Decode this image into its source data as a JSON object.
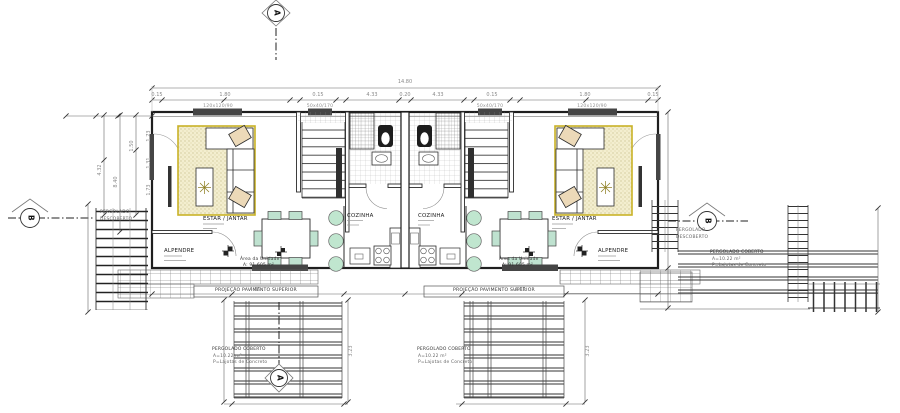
{
  "rooms": {
    "estar_jantar": "ESTAR / JANTAR",
    "cozinha": "COZINHA",
    "alpendre": "ALPENDRE",
    "area_line1": "Área da Unidade",
    "area_line2": "A: 91.605 m²"
  },
  "pergolas": {
    "coberto_title": "PERGOLADO COBERTO",
    "coberto_area": "A=10.22 m²",
    "coberto_floor": "P=Lajotas de Concreto",
    "descoberto_line1": "PERGOLADO",
    "descoberto_line2": "DESCOBERTO"
  },
  "projection": {
    "label": "PROJEÇÃO PAVIMENTO SUPERIOR"
  },
  "markers": {
    "section_a": "A",
    "section_b": "B"
  },
  "windows": {
    "large": "120x120/90",
    "small": "50x40/170"
  },
  "dims": {
    "total_width": "14.80",
    "top_segments": [
      "0.15",
      "1.80",
      "0.15",
      "4.33",
      "0.20",
      "4.33",
      "0.15",
      "1.80",
      "0.15"
    ],
    "left_vertical": [
      "1.50",
      "4.32",
      "8.40"
    ],
    "interior_vertical": [
      "1.73",
      "1.31",
      "1.73"
    ],
    "bottom_left": "4.85",
    "bottom_right": "4.85",
    "pergola_height": "3.23"
  },
  "colors": {
    "line": "#2b2b2b",
    "rug_border": "#c9b227",
    "rug_fill": "#f3eecf",
    "cushion": "#ecd9b8",
    "chair": "#bfe2d0",
    "window_fill": "#454545",
    "dim_text": "#8a8a8a"
  }
}
